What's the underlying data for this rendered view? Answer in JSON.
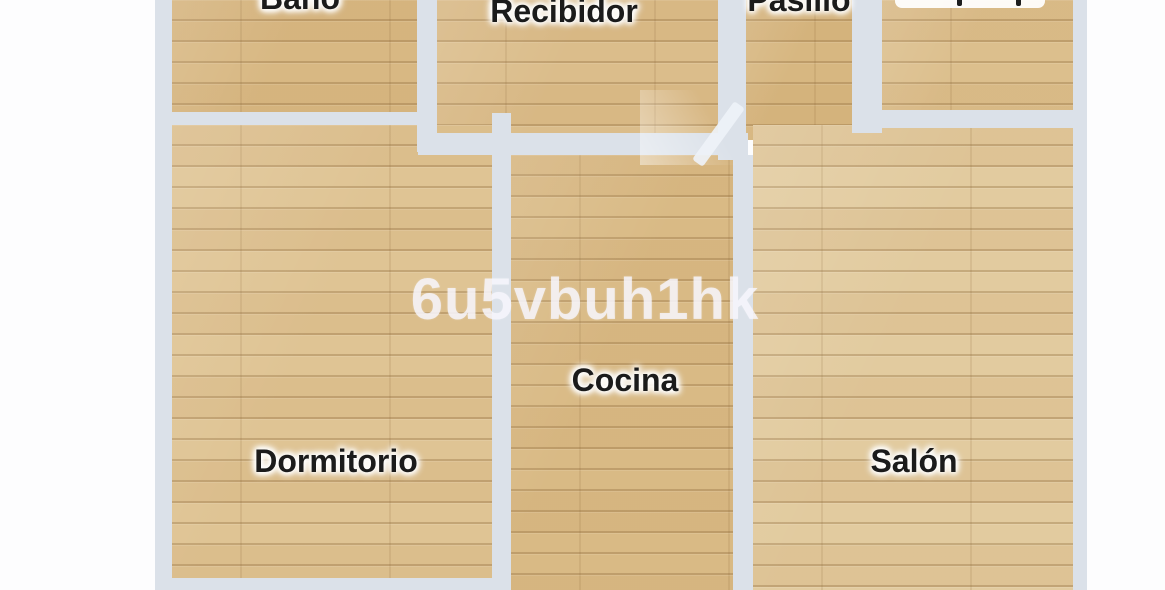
{
  "plan": {
    "type": "apartment-floorplan-top-view",
    "watermark": {
      "text": "6u5vbuh1hk",
      "color": "#f7f5fc"
    },
    "rooms": {
      "banyo": {
        "label": "Baño",
        "cut_off": true
      },
      "recibidor": {
        "label": "Recibidor",
        "cut_off": false
      },
      "pasillo": {
        "label": "Pasillo",
        "cut_off": true
      },
      "dormitorio": {
        "label": "Dormitorio",
        "cut_off": false
      },
      "cocina": {
        "label": "Cocina",
        "cut_off": false
      },
      "salon": {
        "label": "Salón",
        "cut_off": false
      }
    },
    "unreadable_label_fragment": true,
    "colors": {
      "wall": "#dbe1e9",
      "floor_wood_base": "#dcbd8a",
      "outside_background": "#ffffff",
      "label_text": "#1b1b1b"
    }
  }
}
